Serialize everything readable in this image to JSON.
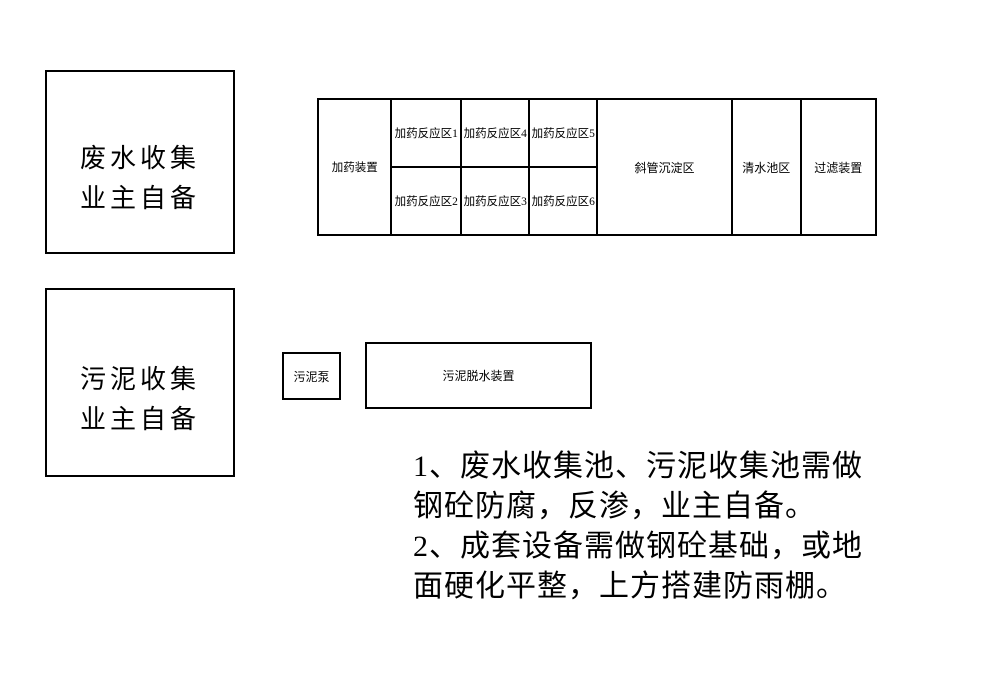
{
  "left_boxes": {
    "wastewater": {
      "line1": "废水收集",
      "line2": "业主自备"
    },
    "sludge": {
      "line1": "污泥收集",
      "line2": "业主自备"
    }
  },
  "process_grid": {
    "dosing_device": "加药装置",
    "reaction_zones_top": [
      "加药反应区1",
      "加药反应区4",
      "加药反应区5"
    ],
    "reaction_zones_bottom": [
      "加药反应区2",
      "加药反应区3",
      "加药反应区6"
    ],
    "sedimentation_zone": "斜管沉淀区",
    "clear_water_pool": "清水池区",
    "filter_device": "过滤装置"
  },
  "sludge_line": {
    "pump": "污泥泵",
    "dewatering_device": "污泥脱水装置"
  },
  "notes": {
    "line1": "1、废水收集池、污泥收集池需做",
    "line2": "钢砼防腐，反渗，业主自备。",
    "line3": "2、成套设备需做钢砼基础，或地",
    "line4": "面硬化平整，上方搭建防雨棚。"
  },
  "colors": {
    "line": "#000000",
    "background": "#ffffff",
    "text": "#000000"
  }
}
